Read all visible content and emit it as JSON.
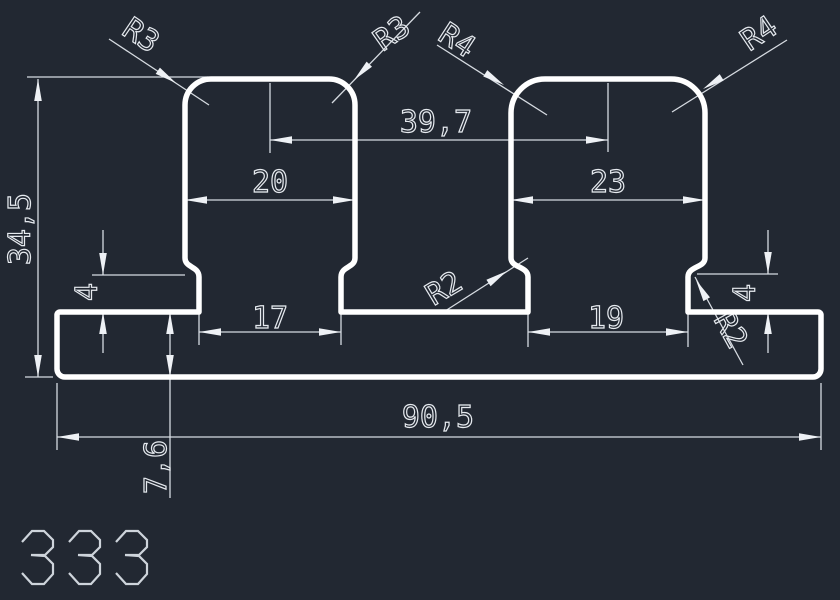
{
  "canvas": {
    "background": "#222832",
    "profile_color": "#ffffff",
    "dimension_line_color": "#d6dbe1",
    "text_color": "#e6eaef"
  },
  "part_number": "333",
  "dimensions": {
    "total_height": "34,5",
    "tower_spacing": "39,7",
    "left_tower_width": "20",
    "right_tower_width": "23",
    "left_neck_width": "17",
    "right_neck_width": "19",
    "base_width": "90,5",
    "base_height": "7,6",
    "left_step_height": "4",
    "right_step_height": "4"
  },
  "radius_labels": {
    "left_tower_left_corner": "R3",
    "left_tower_right_corner": "R3",
    "right_tower_left_corner": "R4",
    "right_tower_right_corner": "R4",
    "center_fillet": "R2",
    "right_fillet": "R2"
  }
}
